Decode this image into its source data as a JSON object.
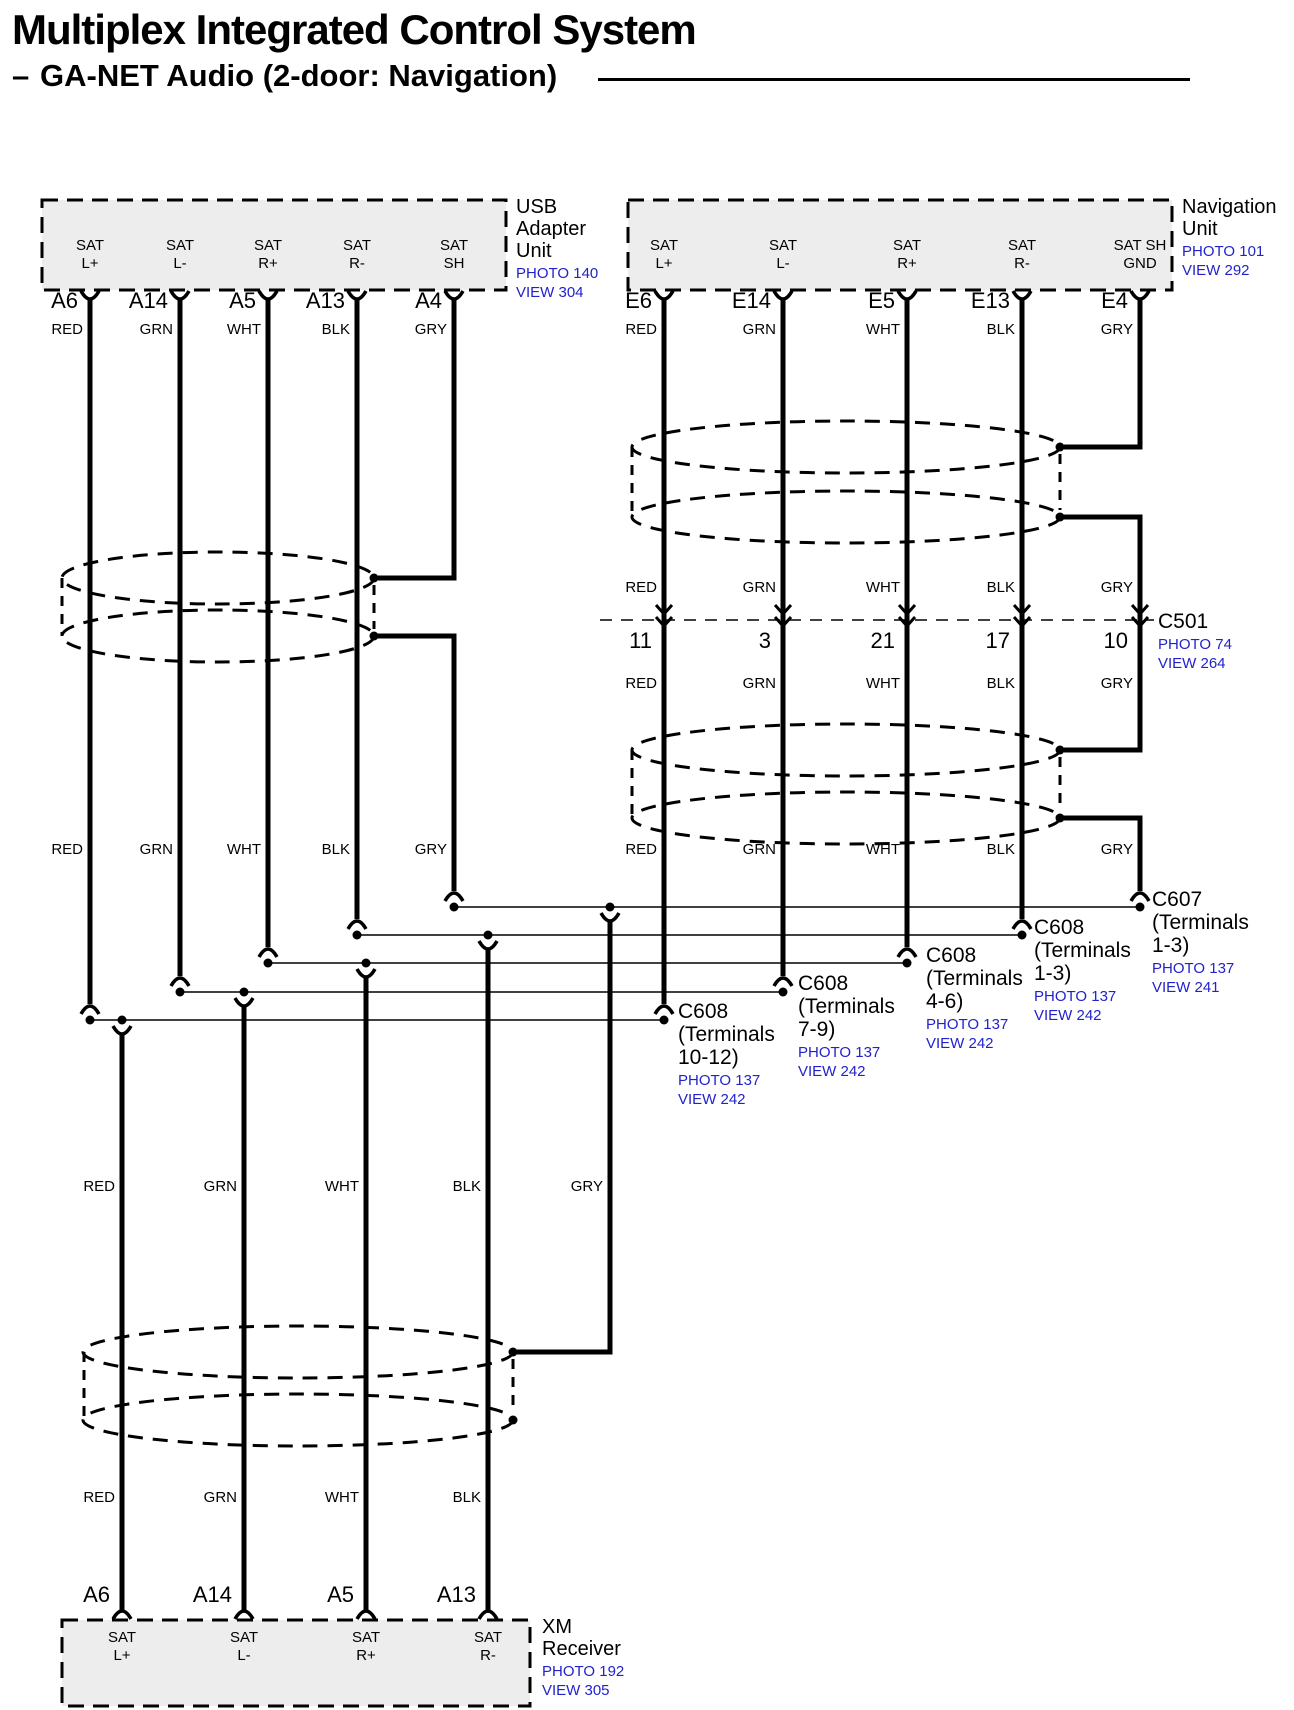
{
  "header": {
    "title": "Multiplex Integrated Control System",
    "dash": "–",
    "subtitle": "GA-NET Audio (2-door: Navigation)"
  },
  "colors": {
    "blue": "#2222CC",
    "black": "#000000",
    "box_fill": "#EDEDED"
  },
  "wire_colors": {
    "left_top": [
      "RED",
      "GRN",
      "WHT",
      "BLK",
      "GRY"
    ],
    "right_top": [
      "RED",
      "GRN",
      "WHT",
      "BLK",
      "GRY"
    ],
    "right_mid1": [
      "RED",
      "GRN",
      "WHT",
      "BLK",
      "GRY"
    ],
    "right_mid2": [
      "RED",
      "GRN",
      "WHT",
      "BLK",
      "GRY"
    ],
    "left_mid": [
      "RED",
      "GRN",
      "WHT",
      "BLK",
      "GRY"
    ],
    "right_low": [
      "RED",
      "GRN",
      "WHT",
      "BLK",
      "GRY"
    ],
    "bottom_mid": [
      "RED",
      "GRN",
      "WHT",
      "BLK",
      "GRY"
    ],
    "bottom_low": [
      "RED",
      "GRN",
      "WHT",
      "BLK"
    ]
  },
  "units": {
    "usb_adapter": {
      "name_lines": [
        "USB",
        "Adapter",
        "Unit"
      ],
      "photo": "PHOTO 140",
      "view": "VIEW 304",
      "pins": [
        "A6",
        "A14",
        "A5",
        "A13",
        "A4"
      ],
      "terminals": [
        [
          "SAT",
          "L+"
        ],
        [
          "SAT",
          "L-"
        ],
        [
          "SAT",
          "R+"
        ],
        [
          "SAT",
          "R-"
        ],
        [
          "SAT",
          "SH"
        ]
      ]
    },
    "navigation": {
      "name_lines": [
        "Navigation",
        "Unit"
      ],
      "photo": "PHOTO 101",
      "view": "VIEW 292",
      "pins": [
        "E6",
        "E14",
        "E5",
        "E13",
        "E4"
      ],
      "terminals": [
        [
          "SAT",
          "L+"
        ],
        [
          "SAT",
          "L-"
        ],
        [
          "SAT",
          "R+"
        ],
        [
          "SAT",
          "R-"
        ],
        [
          "SAT SH",
          "GND"
        ]
      ]
    },
    "xm_receiver": {
      "name_lines": [
        "XM",
        "Receiver"
      ],
      "photo": "PHOTO 192",
      "view": "VIEW 305",
      "pins": [
        "A6",
        "A14",
        "A5",
        "A13"
      ],
      "terminals": [
        [
          "SAT",
          "L+"
        ],
        [
          "SAT",
          "L-"
        ],
        [
          "SAT",
          "R+"
        ],
        [
          "SAT",
          "R-"
        ]
      ]
    }
  },
  "connectors": {
    "c501": {
      "name": "C501",
      "photo": "PHOTO 74",
      "view": "VIEW 264",
      "pins": [
        "11",
        "3",
        "21",
        "17",
        "10"
      ]
    },
    "c607": {
      "name": "C607",
      "terminal_lines": [
        "(Terminals",
        "1-3)"
      ],
      "photo": "PHOTO 137",
      "view": "VIEW 241"
    },
    "c608_a": {
      "name": "C608",
      "terminal_lines": [
        "(Terminals",
        "1-3)"
      ],
      "photo": "PHOTO 137",
      "view": "VIEW 242"
    },
    "c608_b": {
      "name": "C608",
      "terminal_lines": [
        "(Terminals",
        "4-6)"
      ],
      "photo": "PHOTO 137",
      "view": "VIEW 242"
    },
    "c608_c": {
      "name": "C608",
      "terminal_lines": [
        "(Terminals",
        "7-9)"
      ],
      "photo": "PHOTO 137",
      "view": "VIEW 242"
    },
    "c608_d": {
      "name": "C608",
      "terminal_lines": [
        "(Terminals",
        "10-12)"
      ],
      "photo": "PHOTO 137",
      "view": "VIEW 242"
    }
  }
}
